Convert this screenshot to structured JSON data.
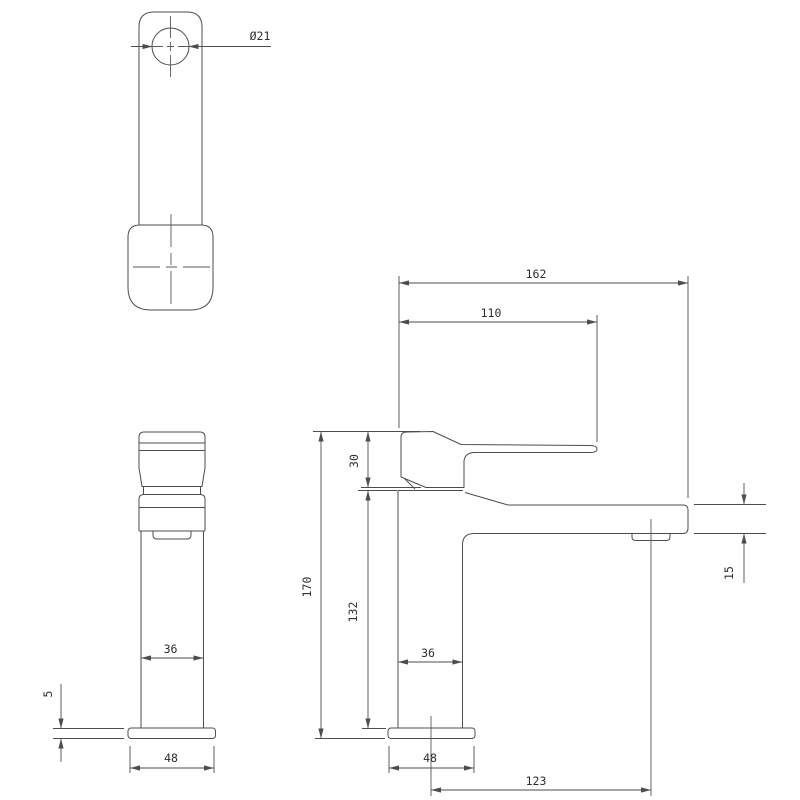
{
  "drawing": {
    "type": "faucet-technical-drawing",
    "colors": {
      "background": "#ffffff",
      "line": "#4d4d4d",
      "text": "#2e2e2e"
    },
    "views": {
      "top": {
        "hole_diameter": "Ø21"
      },
      "front": {
        "body_width": "36",
        "base_thickness": "5",
        "base_width": "48"
      },
      "side": {
        "overall_depth": "162",
        "lever_reach": "110",
        "handle_height": "30",
        "overall_height": "170",
        "body_height": "132",
        "body_depth": "36",
        "spout_end_height": "15",
        "base_depth": "48",
        "spout_outlet_offset": "123"
      }
    }
  }
}
